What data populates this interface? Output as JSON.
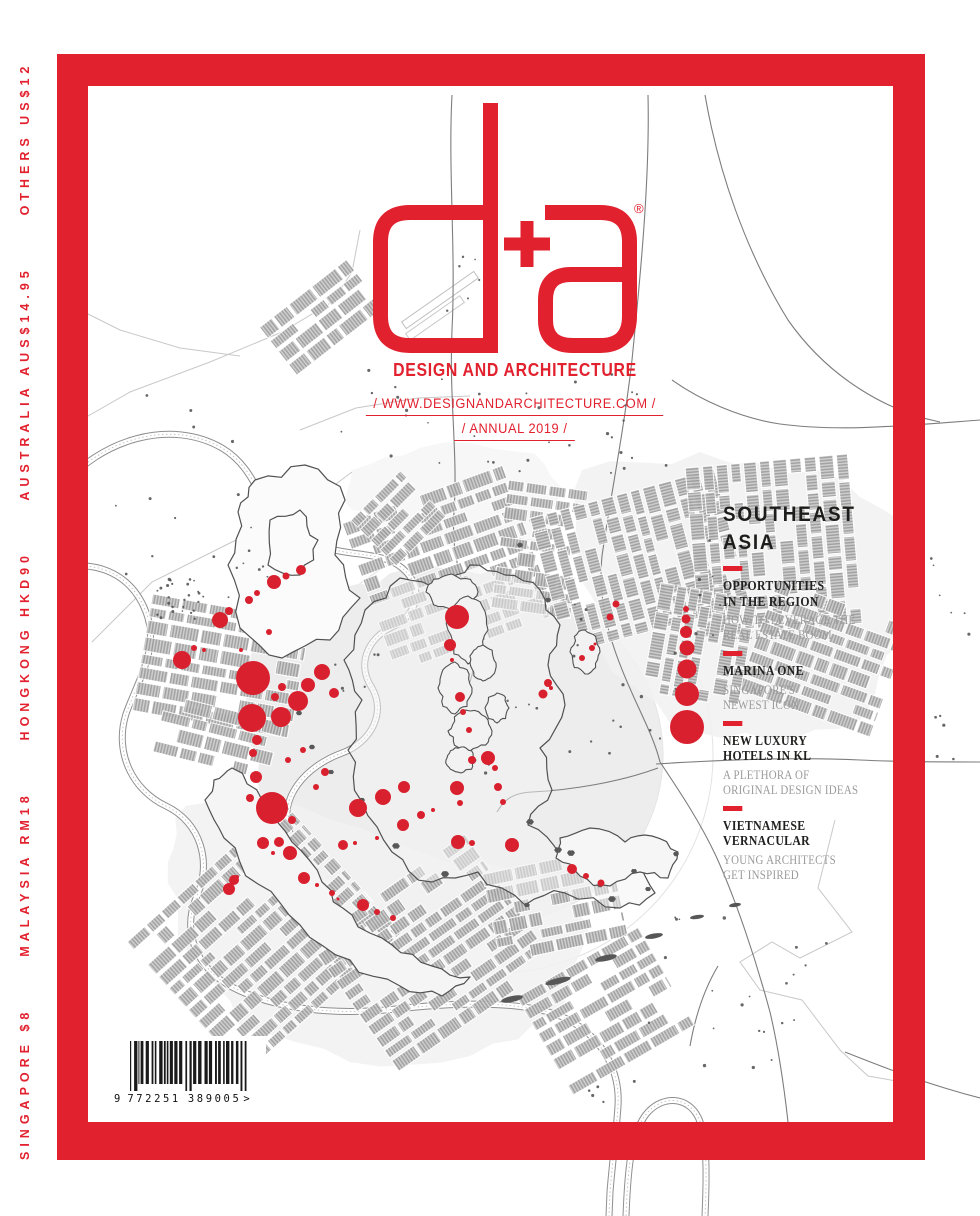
{
  "brand": {
    "logo_text": "d+a",
    "registered_mark": "®",
    "tagline": "DESIGN AND ARCHITECTURE",
    "website_line": "/ WWW.DESIGNANDARCHITECTURE.COM /",
    "issue_line": "/ ANNUAL 2019 /"
  },
  "colors": {
    "accent_red": "#E2212E",
    "heading_dark": "#1D1D1B",
    "subtitle_gray": "#9B9B9B"
  },
  "cover": {
    "region_title_line1": "SOUTHEAST",
    "region_title_line2": "ASIA",
    "articles": [
      {
        "title_lines": [
          "OPPORTUNITIES",
          "IN THE REGION"
        ],
        "subtitle_lines": [
          "HOW-TO LEVERAGE THE",
          "REAL ESTATE BOOM"
        ]
      },
      {
        "title_lines": [
          "MARINA ONE"
        ],
        "subtitle_lines": [
          "SINGAPORE'S",
          "NEWEST ICON"
        ]
      },
      {
        "title_lines": [
          "NEW LUXURY",
          "HOTELS IN KL"
        ],
        "subtitle_lines": [
          "A PLETHORA OF",
          "ORIGINAL DESIGN IDEAS"
        ]
      },
      {
        "title_lines": [
          "VIETNAMESE",
          "VERNACULAR"
        ],
        "subtitle_lines": [
          "YOUNG ARCHITECTS",
          "GET INSPIRED"
        ]
      }
    ]
  },
  "spine": {
    "price_text": "SINGAPORE $8      MALAYSIA RM18      HONGKONG HKD90      AUSTRALIA AUS$14.95      OTHERS US$12"
  },
  "barcode": {
    "number_left": "9",
    "number_mid": "772251",
    "number_right": "389005",
    "suffix": ">"
  },
  "map": {
    "dot_red": "#D9202E",
    "red_dots": [
      [
        301,
        570,
        5
      ],
      [
        274,
        582,
        7
      ],
      [
        286,
        576,
        3.5
      ],
      [
        249,
        600,
        4
      ],
      [
        257,
        593,
        3
      ],
      [
        229,
        611,
        4
      ],
      [
        220,
        620,
        8
      ],
      [
        194,
        648,
        3
      ],
      [
        182,
        660,
        9
      ],
      [
        204,
        650,
        2
      ],
      [
        253,
        678,
        17
      ],
      [
        322,
        672,
        8
      ],
      [
        308,
        685,
        7
      ],
      [
        334,
        693,
        5
      ],
      [
        298,
        701,
        10
      ],
      [
        282,
        687,
        4
      ],
      [
        275,
        697,
        4
      ],
      [
        252,
        718,
        14
      ],
      [
        281,
        717,
        10
      ],
      [
        257,
        740,
        5
      ],
      [
        253,
        753,
        4
      ],
      [
        303,
        750,
        3
      ],
      [
        288,
        760,
        3
      ],
      [
        325,
        772,
        4
      ],
      [
        316,
        787,
        3
      ],
      [
        256,
        777,
        6
      ],
      [
        250,
        798,
        4
      ],
      [
        272,
        808,
        16
      ],
      [
        292,
        820,
        4
      ],
      [
        263,
        843,
        6
      ],
      [
        279,
        842,
        5
      ],
      [
        290,
        853,
        7
      ],
      [
        273,
        853,
        2
      ],
      [
        304,
        878,
        6
      ],
      [
        234,
        880,
        5
      ],
      [
        229,
        889,
        6
      ],
      [
        343,
        845,
        5
      ],
      [
        355,
        843,
        2
      ],
      [
        358,
        808,
        9
      ],
      [
        377,
        838,
        2
      ],
      [
        383,
        797,
        8
      ],
      [
        404,
        787,
        6
      ],
      [
        421,
        815,
        4
      ],
      [
        403,
        825,
        6
      ],
      [
        433,
        810,
        2
      ],
      [
        457,
        617,
        12
      ],
      [
        450,
        645,
        6
      ],
      [
        452,
        660,
        2
      ],
      [
        460,
        697,
        5
      ],
      [
        463,
        712,
        3
      ],
      [
        469,
        730,
        3
      ],
      [
        472,
        760,
        4
      ],
      [
        488,
        758,
        7
      ],
      [
        495,
        768,
        3
      ],
      [
        457,
        788,
        7
      ],
      [
        460,
        803,
        3
      ],
      [
        498,
        787,
        4
      ],
      [
        503,
        802,
        3
      ],
      [
        458,
        842,
        7
      ],
      [
        472,
        843,
        3
      ],
      [
        512,
        845,
        7
      ],
      [
        548,
        683,
        4
      ],
      [
        616,
        604,
        3.5
      ],
      [
        610,
        617,
        3.5
      ],
      [
        592,
        648,
        3
      ],
      [
        582,
        658,
        3
      ],
      [
        595,
        644,
        1.5
      ],
      [
        543,
        694,
        4.5
      ],
      [
        551,
        688,
        2
      ],
      [
        317,
        885,
        2
      ],
      [
        332,
        893,
        3
      ],
      [
        338,
        899,
        1.5
      ],
      [
        363,
        905,
        6
      ],
      [
        377,
        912,
        3
      ],
      [
        393,
        918,
        3
      ],
      [
        572,
        869,
        5
      ],
      [
        586,
        876,
        3
      ],
      [
        601,
        883,
        3.5
      ],
      [
        237,
        877,
        2
      ],
      [
        269,
        632,
        3
      ],
      [
        241,
        650,
        2
      ]
    ],
    "legend_dots": [
      [
        686,
        609,
        3
      ],
      [
        686,
        619,
        4.5
      ],
      [
        686,
        632,
        6
      ],
      [
        687,
        648,
        7.5
      ],
      [
        687,
        669,
        9.5
      ],
      [
        687,
        694,
        12
      ],
      [
        687,
        727,
        17
      ]
    ],
    "clusters": [
      {
        "x": 322,
        "y": 318,
        "w": 110,
        "h": 62,
        "r": -38
      },
      {
        "x": 448,
        "y": 565,
        "w": 170,
        "h": 150,
        "r": -20
      },
      {
        "x": 540,
        "y": 545,
        "w": 80,
        "h": 120,
        "r": 8
      },
      {
        "x": 395,
        "y": 515,
        "w": 70,
        "h": 55,
        "r": -45
      },
      {
        "x": 645,
        "y": 560,
        "w": 140,
        "h": 180,
        "r": 75
      },
      {
        "x": 780,
        "y": 545,
        "w": 170,
        "h": 150,
        "r": 85
      },
      {
        "x": 825,
        "y": 655,
        "w": 140,
        "h": 110,
        "r": 20
      },
      {
        "x": 698,
        "y": 645,
        "w": 110,
        "h": 100,
        "r": 100
      },
      {
        "x": 222,
        "y": 662,
        "w": 160,
        "h": 110,
        "r": 10
      },
      {
        "x": 218,
        "y": 738,
        "w": 120,
        "h": 60,
        "r": 14
      },
      {
        "x": 262,
        "y": 935,
        "w": 210,
        "h": 170,
        "r": -42
      },
      {
        "x": 430,
        "y": 950,
        "w": 190,
        "h": 150,
        "r": -35
      },
      {
        "x": 555,
        "y": 905,
        "w": 130,
        "h": 90,
        "r": -12
      },
      {
        "x": 605,
        "y": 1010,
        "w": 140,
        "h": 110,
        "r": -30
      }
    ],
    "circles": [
      {
        "cx": 495,
        "cy": 755,
        "r": 218,
        "f": "none",
        "s": "#E3E3E3",
        "o": 1
      },
      {
        "cx": 495,
        "cy": 755,
        "r": 168,
        "f": "#E9E9E9",
        "s": "#DFDFDF",
        "o": 0.8
      }
    ],
    "regions": [
      {
        "fill": "#EDEDED",
        "o": 1,
        "pts": [
          [
            252,
            652
          ],
          [
            300,
            600
          ],
          [
            358,
            584
          ],
          [
            420,
            558
          ],
          [
            500,
            568
          ],
          [
            558,
            598
          ],
          [
            600,
            640
          ],
          [
            642,
            700
          ],
          [
            652,
            782
          ],
          [
            622,
            852
          ],
          [
            560,
            902
          ],
          [
            478,
            932
          ],
          [
            398,
            922
          ],
          [
            328,
            880
          ],
          [
            278,
            820
          ],
          [
            248,
            740
          ]
        ]
      },
      {
        "fill": "#F1F1F1",
        "o": 0.85,
        "pts": [
          [
            582,
            470
          ],
          [
            700,
            452
          ],
          [
            820,
            470
          ],
          [
            900,
            520
          ],
          [
            905,
            640
          ],
          [
            860,
            720
          ],
          [
            770,
            740
          ],
          [
            672,
            726
          ],
          [
            600,
            650
          ],
          [
            578,
            560
          ]
        ]
      },
      {
        "fill": "#F1F1F1",
        "o": 0.85,
        "pts": [
          [
            186,
            806
          ],
          [
            300,
            806
          ],
          [
            420,
            852
          ],
          [
            540,
            872
          ],
          [
            588,
            930
          ],
          [
            560,
            1010
          ],
          [
            470,
            1056
          ],
          [
            350,
            1062
          ],
          [
            240,
            1026
          ],
          [
            178,
            940
          ],
          [
            168,
            862
          ]
        ]
      },
      {
        "fill": "#F2F2F2",
        "o": 0.6,
        "pts": [
          [
            352,
            470
          ],
          [
            420,
            448
          ],
          [
            520,
            452
          ],
          [
            560,
            486
          ],
          [
            540,
            540
          ],
          [
            470,
            552
          ],
          [
            396,
            540
          ],
          [
            352,
            510
          ]
        ]
      }
    ],
    "rivers": [
      "M62,487C100,440 170,418 222,448C262,472 258,515 298,537C340,560 378,548 402,568C425,587 418,615 392,627C368,638 356,664 372,688C386,712 372,742 342,753C306,766 277,798 290,833",
      "M62,568C98,560 132,575 146,612C160,648 138,680 126,714C114,752 132,790 166,806C200,822 213,862 196,898C182,932 196,968 232,987C272,1008 330,1016 396,1009C470,1001 540,1001 574,1023C606,1043 620,1074 618,1106C616,1136 612,1166 610,1192L609,1216",
      "M626,1216C628,1162 632,1130 648,1112C664,1095 688,1097 698,1117C707,1135 707,1172 705,1216"
    ],
    "roads": [
      "M452,95C448,170 456,250 452,330C449,400 458,452 454,512C451,556 462,582 470,604C478,640 476,664 470,682",
      "M648,95C650,180 640,280 632,360C624,430 610,500 602,556C596,612 618,662 636,702C650,732 656,746 660,762",
      "M660,762C680,792 700,822 716,856C736,900 756,960 770,1012C778,1046 784,1086 788,1122",
      "M718,966C706,986 696,1012 690,1046",
      "M656,764C720,760 800,757 860,760C900,762 940,762 980,762",
      "M658,768C620,782 572,790 532,792C512,793 504,800 497,812",
      "M980,420C900,426 840,432 780,424C740,418 700,400 672,380",
      "M705,95C718,170 745,250 788,320C830,380 890,412 940,422",
      "M845,1052C890,1070 930,1085 980,1098"
    ],
    "light_lines": [
      "M60,432L130,392L210,362L282,332L332,302L352,272L360,230",
      "M92,642L152,582L232,542L312,502L352,472",
      "M835,820L818,888L852,932L800,958L772,942L740,962L760,990L802,1000L840,1050L868,1076L902,1082",
      "M300,430L356,408L418,398L470,396",
      "M60,300L120,330L180,348L240,356"
    ],
    "lands": [
      {
        "fill": "#FBFBFB",
        "pts": [
          [
            255,
            480
          ],
          [
            305,
            465
          ],
          [
            345,
            500
          ],
          [
            335,
            555
          ],
          [
            360,
            598
          ],
          [
            330,
            640
          ],
          [
            282,
            658
          ],
          [
            240,
            628
          ],
          [
            228,
            565
          ],
          [
            238,
            512
          ]
        ]
      },
      {
        "fill": "none",
        "pts": [
          [
            270,
            520
          ],
          [
            300,
            510
          ],
          [
            318,
            540
          ],
          [
            300,
            575
          ],
          [
            268,
            565
          ]
        ]
      },
      {
        "fill": "rgba(243,243,243,0.5)",
        "pts": [
          [
            365,
            610
          ],
          [
            400,
            578
          ],
          [
            445,
            588
          ],
          [
            470,
            565
          ],
          [
            505,
            575
          ],
          [
            540,
            590
          ],
          [
            560,
            625
          ],
          [
            548,
            665
          ],
          [
            565,
            705
          ],
          [
            540,
            748
          ],
          [
            552,
            790
          ],
          [
            528,
            825
          ],
          [
            560,
            855
          ],
          [
            600,
            845
          ],
          [
            638,
            862
          ],
          [
            655,
            893
          ],
          [
            620,
            908
          ],
          [
            565,
            893
          ],
          [
            525,
            905
          ],
          [
            478,
            872
          ],
          [
            432,
            882
          ],
          [
            392,
            852
          ],
          [
            362,
            802
          ],
          [
            348,
            750
          ],
          [
            362,
            700
          ],
          [
            344,
            660
          ]
        ]
      },
      {
        "fill": "#F5F5F5",
        "pts": [
          [
            232,
            768
          ],
          [
            262,
            800
          ],
          [
            292,
            842
          ],
          [
            322,
            882
          ],
          [
            352,
            915
          ],
          [
            392,
            945
          ],
          [
            432,
            966
          ],
          [
            470,
            977
          ],
          [
            442,
            996
          ],
          [
            400,
            986
          ],
          [
            350,
            960
          ],
          [
            300,
            925
          ],
          [
            258,
            884
          ],
          [
            224,
            838
          ],
          [
            205,
            800
          ],
          [
            214,
            780
          ]
        ]
      },
      {
        "fill": "#F6F6F6",
        "pts": [
          [
            560,
            838
          ],
          [
            590,
            828
          ],
          [
            625,
            842
          ],
          [
            652,
            836
          ],
          [
            678,
            852
          ],
          [
            668,
            878
          ],
          [
            640,
            872
          ],
          [
            610,
            886
          ],
          [
            580,
            876
          ],
          [
            556,
            858
          ]
        ]
      }
    ],
    "outline_blobs": [
      [
        452,
        592,
        26,
        18
      ],
      [
        468,
        630,
        20,
        34
      ],
      [
        455,
        688,
        17,
        26
      ],
      [
        483,
        663,
        13,
        18
      ],
      [
        470,
        731,
        22,
        20
      ],
      [
        497,
        708,
        12,
        15
      ],
      [
        461,
        760,
        15,
        13
      ],
      [
        585,
        652,
        15,
        22
      ]
    ],
    "dark_blobs": [
      [
        530,
        822,
        4
      ],
      [
        558,
        850,
        4
      ],
      [
        612,
        899,
        4
      ],
      [
        648,
        889,
        3
      ],
      [
        445,
        874,
        4
      ],
      [
        396,
        846,
        4
      ],
      [
        362,
        800,
        3
      ],
      [
        299,
        713,
        3
      ],
      [
        312,
        747,
        3
      ],
      [
        331,
        772,
        3
      ],
      [
        527,
        905,
        3
      ],
      [
        571,
        853,
        4
      ],
      [
        634,
        871,
        3
      ],
      [
        676,
        854,
        3
      ],
      [
        600,
        885,
        3
      ],
      [
        520,
        545,
        3
      ],
      [
        548,
        600,
        3
      ]
    ],
    "islets": [
      [
        512,
        999,
        11,
        3,
        -12
      ],
      [
        558,
        981,
        13,
        3,
        -14
      ],
      [
        606,
        958,
        11,
        3,
        -12
      ],
      [
        654,
        936,
        9,
        2.5,
        -10
      ],
      [
        697,
        917,
        7,
        2,
        -8
      ],
      [
        735,
        905,
        6,
        2,
        -8
      ]
    ],
    "speckle_zones": [
      [
        340,
        370,
        300,
        110,
        28
      ],
      [
        360,
        250,
        130,
        70,
        8
      ],
      [
        560,
        600,
        120,
        180,
        16
      ],
      [
        595,
        430,
        80,
        60,
        6
      ],
      [
        695,
        535,
        30,
        110,
        7
      ],
      [
        75,
        385,
        190,
        215,
        14
      ],
      [
        157,
        577,
        48,
        45,
        26
      ],
      [
        585,
        1078,
        50,
        25,
        5
      ],
      [
        930,
        555,
        45,
        90,
        6
      ],
      [
        330,
        640,
        60,
        60,
        6
      ],
      [
        230,
        560,
        40,
        40,
        5
      ],
      [
        640,
        900,
        240,
        170,
        22
      ],
      [
        480,
        700,
        60,
        80,
        6
      ],
      [
        900,
        700,
        60,
        100,
        6
      ]
    ]
  }
}
